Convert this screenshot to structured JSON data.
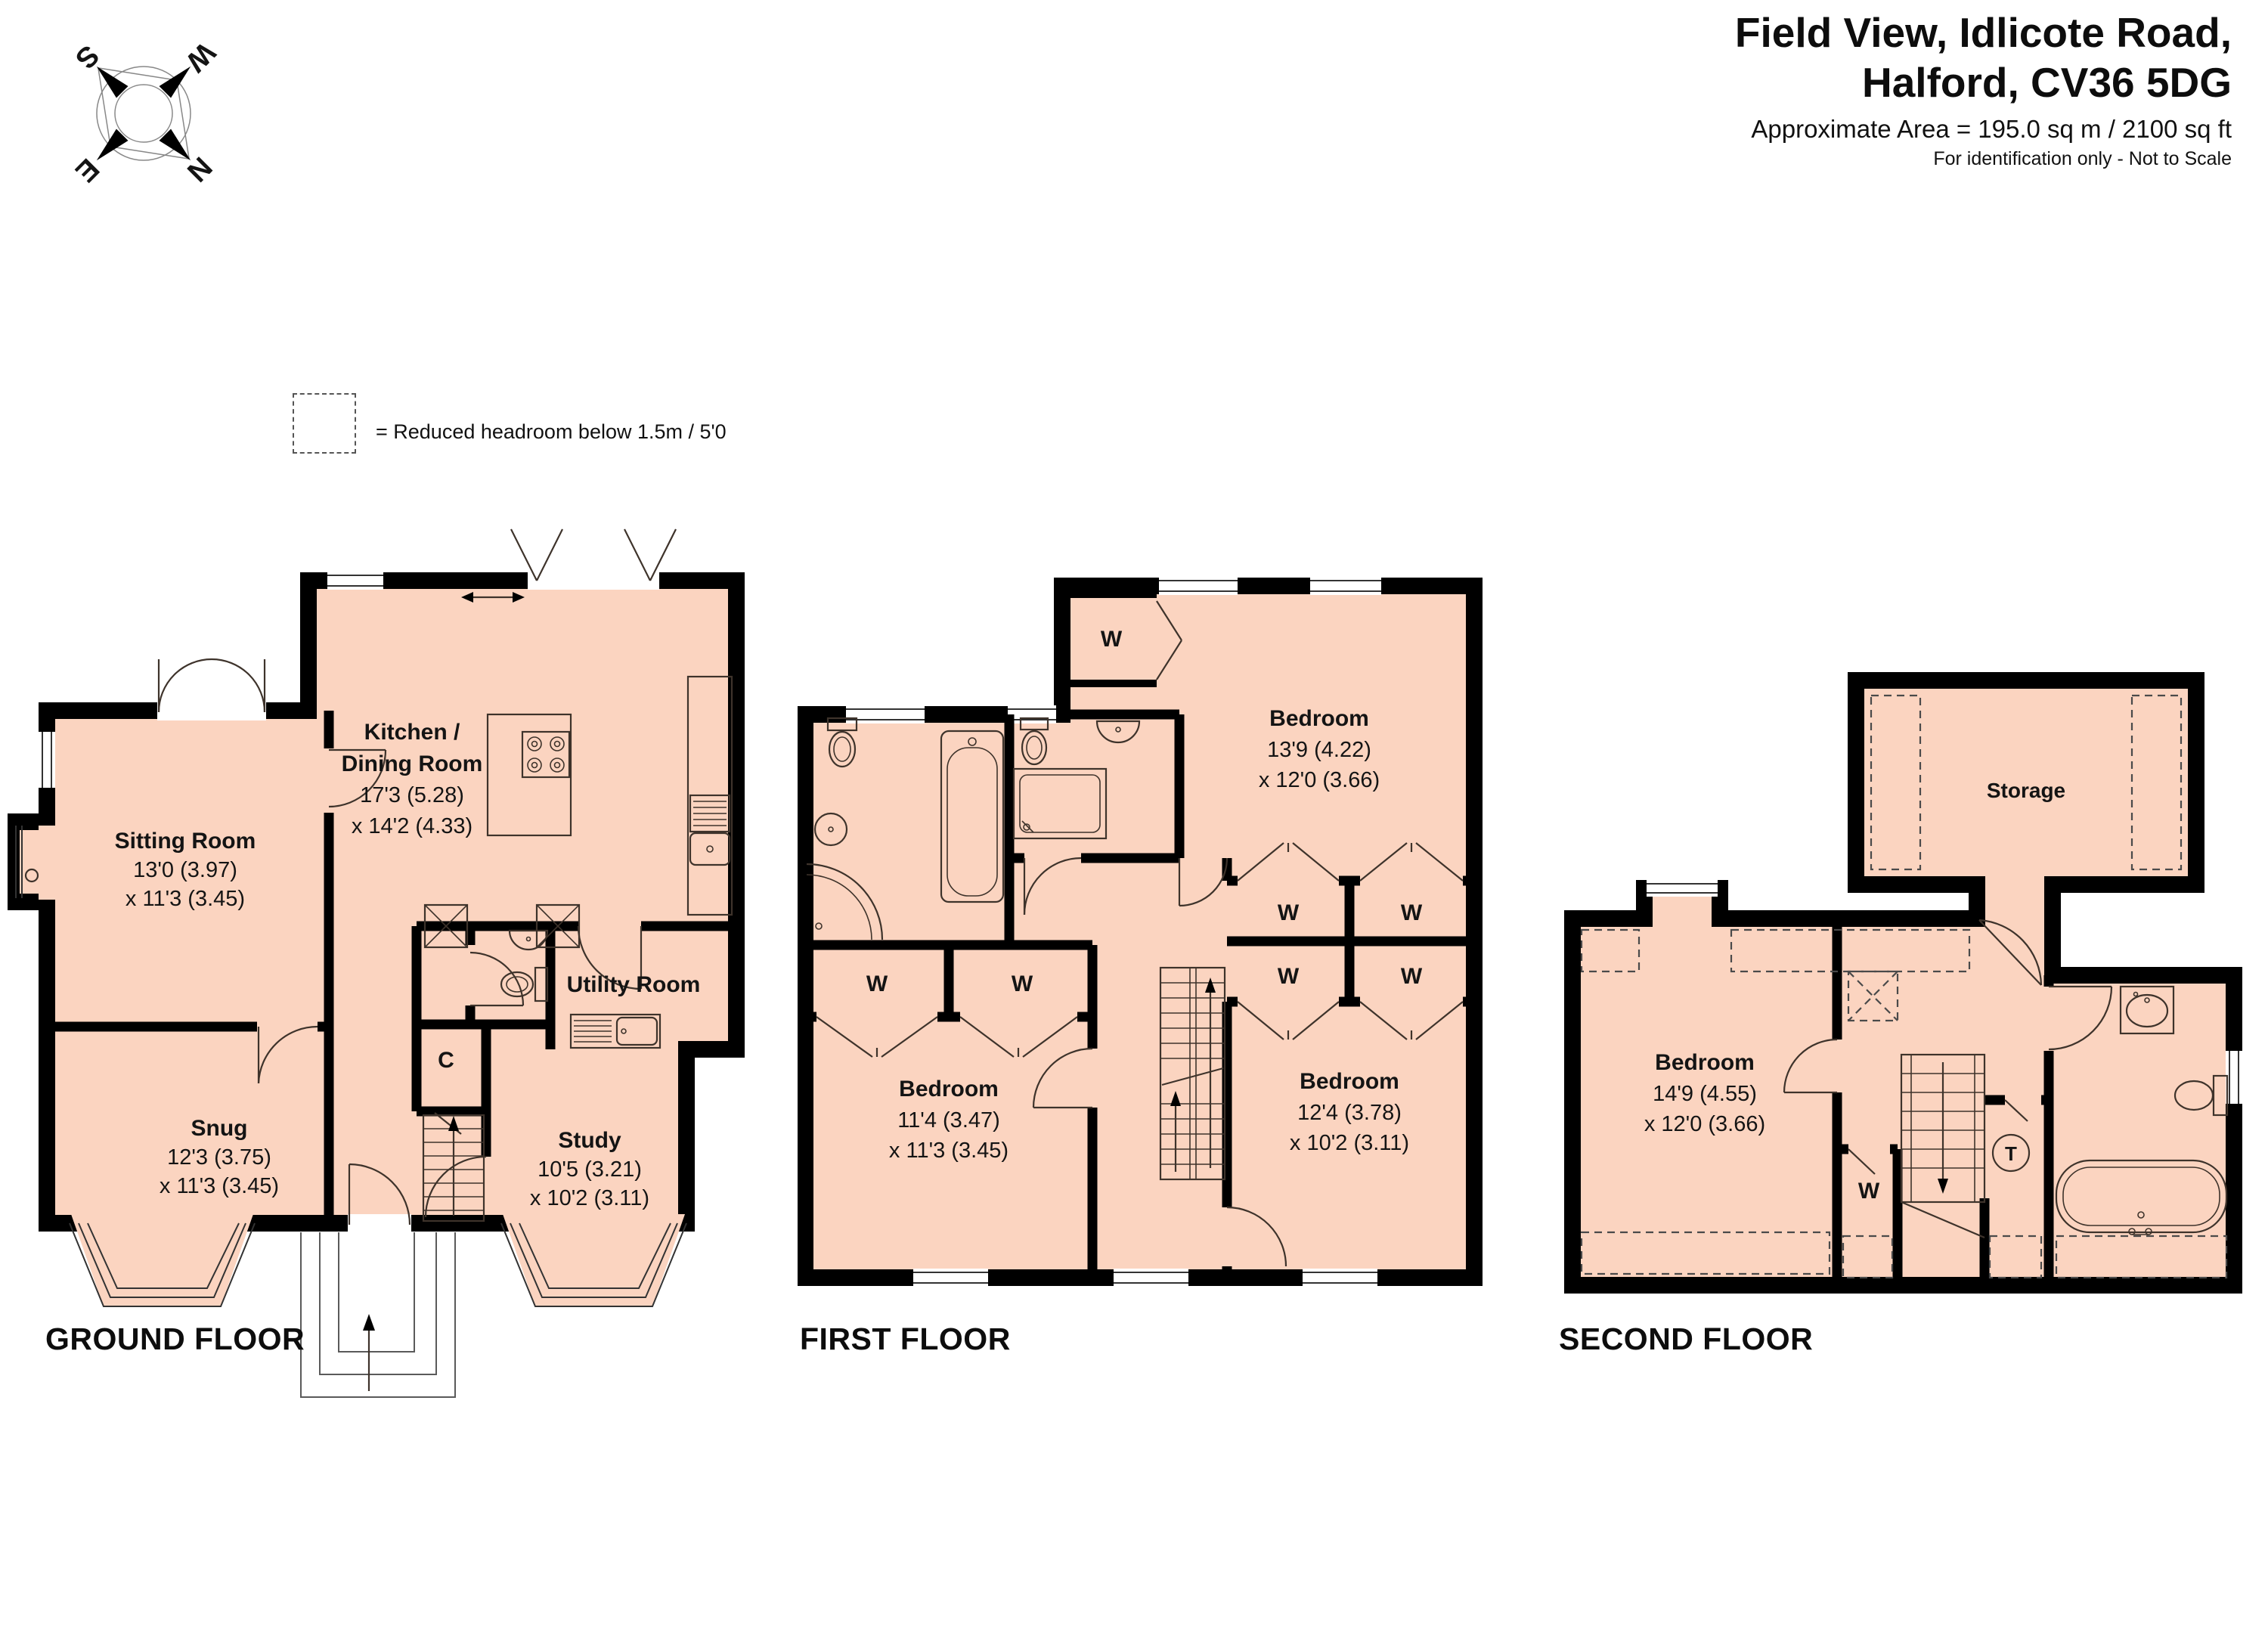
{
  "header": {
    "title_line1": "Field View, Idlicote Road,",
    "title_line2": "Halford, CV36 5DG",
    "area_line": "Approximate Area = 195.0 sq m / 2100 sq ft",
    "disclaimer": "For identification only - Not to Scale"
  },
  "compass": {
    "north": "N",
    "east": "E",
    "south": "S",
    "west": "W"
  },
  "legend": {
    "text": "= Reduced headroom below 1.5m / 5'0"
  },
  "labels": {
    "wardrobe": "W",
    "cupboard": "C",
    "tank": "T"
  },
  "colors": {
    "room_fill": "#FBD4C0",
    "wall": "#000000"
  },
  "floors": {
    "ground": {
      "label": "GROUND FLOOR",
      "rooms": {
        "kitchen": {
          "name_line1": "Kitchen /",
          "name_line2": "Dining Room",
          "dim1": "17'3 (5.28)",
          "dim2": "x 14'2 (4.33)"
        },
        "sitting": {
          "name": "Sitting Room",
          "dim1": "13'0 (3.97)",
          "dim2": "x 11'3 (3.45)"
        },
        "snug": {
          "name": "Snug",
          "dim1": "12'3 (3.75)",
          "dim2": "x 11'3 (3.45)"
        },
        "study": {
          "name": "Study",
          "dim1": "10'5 (3.21)",
          "dim2": "x 10'2 (3.11)"
        },
        "utility": {
          "name": "Utility Room"
        }
      }
    },
    "first": {
      "label": "FIRST FLOOR",
      "rooms": {
        "bedroom1": {
          "name": "Bedroom",
          "dim1": "13'9 (4.22)",
          "dim2": "x 12'0 (3.66)"
        },
        "bedroom2": {
          "name": "Bedroom",
          "dim1": "11'4 (3.47)",
          "dim2": "x 11'3 (3.45)"
        },
        "bedroom3": {
          "name": "Bedroom",
          "dim1": "12'4 (3.78)",
          "dim2": "x 10'2 (3.11)"
        }
      }
    },
    "second": {
      "label": "SECOND FLOOR",
      "rooms": {
        "storage": {
          "name": "Storage"
        },
        "bedroom": {
          "name": "Bedroom",
          "dim1": "14'9 (4.55)",
          "dim2": "x 12'0 (3.66)"
        }
      }
    }
  }
}
